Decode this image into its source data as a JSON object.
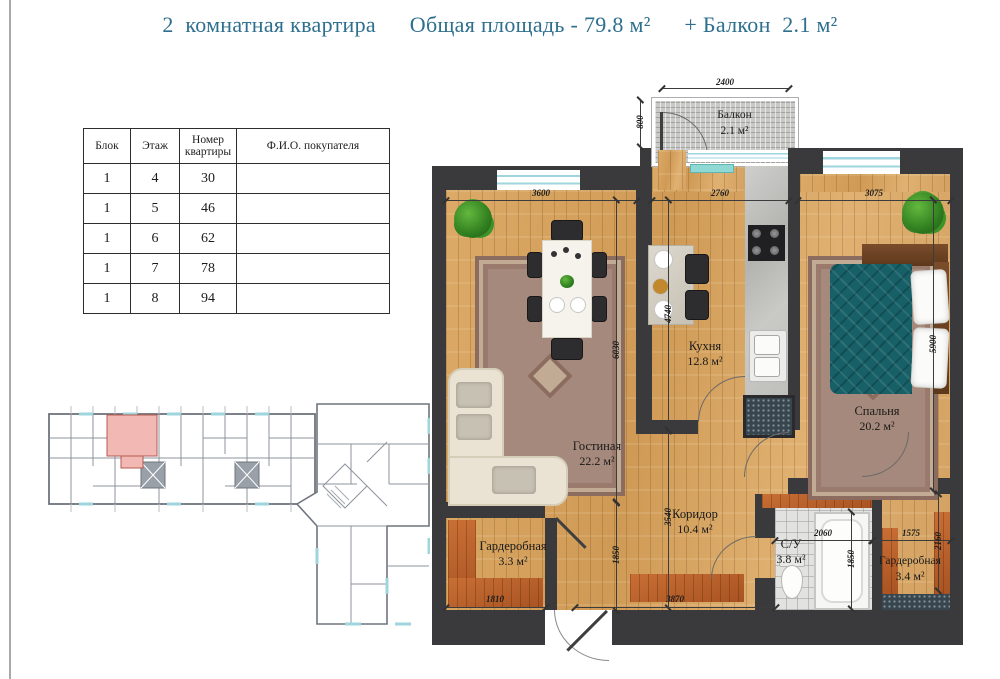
{
  "title": {
    "left": "2  комнатная квартира",
    "mid": "Общая площадь - 79.8 м²",
    "right": "+ Балкон  2.1 м²"
  },
  "buyers_table": {
    "headers": [
      "Блок",
      "Этаж",
      "Номер квартиры",
      "Ф.И.О. покупателя"
    ],
    "rows": [
      {
        "block": "1",
        "floor": "4",
        "apt": "30",
        "buyer": ""
      },
      {
        "block": "1",
        "floor": "5",
        "apt": "46",
        "buyer": ""
      },
      {
        "block": "1",
        "floor": "6",
        "apt": "62",
        "buyer": ""
      },
      {
        "block": "1",
        "floor": "7",
        "apt": "78",
        "buyer": ""
      },
      {
        "block": "1",
        "floor": "8",
        "apt": "94",
        "buyer": ""
      }
    ]
  },
  "plan": {
    "rooms": {
      "balcony": {
        "name": "Балкон",
        "area": "2.1 м²"
      },
      "living": {
        "name": "Гостиная",
        "area": "22.2 м²"
      },
      "kitchen": {
        "name": "Кухня",
        "area": "12.8 м²"
      },
      "bedroom": {
        "name": "Спальня",
        "area": "20.2 м²"
      },
      "corridor": {
        "name": "Коридор",
        "area": "10.4 м²"
      },
      "wardrobe1": {
        "name": "Гардеробная",
        "area": "3.3 м²"
      },
      "bathroom": {
        "name": "С/У",
        "area": "3.8 м²"
      },
      "wardrobe2": {
        "name": "Гардеробная",
        "area": "3.4 м²"
      }
    },
    "dims": {
      "balcony_w": "2400",
      "balcony_d": "800",
      "living_w": "3600",
      "kitchen_w": "2760",
      "bedroom_w": "3075",
      "living_h": "6030",
      "kitchen_h": "4740",
      "bedroom_h": "5900",
      "corridor_h": "3540",
      "hall_h_left": "1850",
      "hall_h_right": "1850",
      "wc_w": "2060",
      "ward2_w": "1575",
      "ward2_h": "2160",
      "ward1_w": "1810",
      "corridor_w": "3870"
    }
  },
  "overview": {
    "highlight_color": "#f2b9b4"
  },
  "colors": {
    "title_text": "#2e6f8e",
    "walls": "#3a3a3c",
    "wood_floor": "#d7a562",
    "wardrobe_wood": "#b5612c",
    "window_glass": "#9fd6de",
    "bed_blanket": "#176068"
  }
}
